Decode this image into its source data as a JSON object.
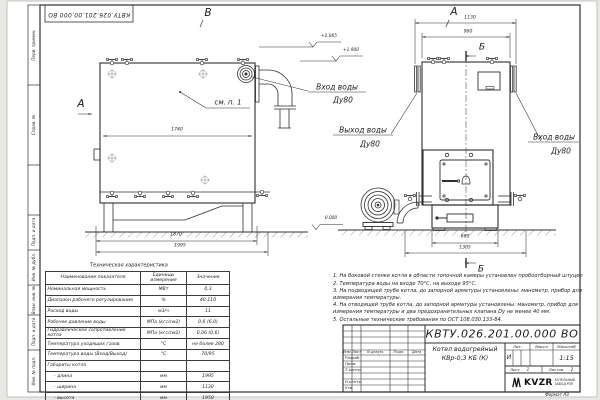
{
  "stamp": "КВТУ.026.201.00.000 ВО",
  "frame_labels": [
    "Перв. примен.",
    "Справ. №",
    "Подп. и дата",
    "Инв. № дубл.",
    "Взам. инв. №",
    "Подп. и дата",
    "Инв. № подл."
  ],
  "views": {
    "b": "В",
    "a_top": "А",
    "a_side": "А",
    "b_section": "Б"
  },
  "elevations": {
    "top": "+2.065",
    "mid": "+1.900",
    "ground": "0.000"
  },
  "callout": "см. п. 1",
  "dims": {
    "side_width": "1740",
    "side_base": "1870",
    "side_total": "1995",
    "front_total": "1130",
    "front_top": "960",
    "front_base": "660",
    "front_span": "1305"
  },
  "pipe_labels": {
    "inlet_side": {
      "l1": "Вход воды",
      "l2": "Ду80"
    },
    "outlet_front": {
      "l1": "Выход воды",
      "l2": "Ду80"
    },
    "inlet_front": {
      "l1": "Вход воды",
      "l2": "Ду80"
    }
  },
  "tech_table": {
    "title": "Техническая характеристика",
    "headers": [
      "Наименование показателя",
      "Единицы измерения",
      "Значение"
    ],
    "rows": [
      [
        "Номинальная мощность",
        "МВт",
        "0,3"
      ],
      [
        "Диапазон рабочего регулирования",
        "%",
        "40-110"
      ],
      [
        "Расход воды",
        "м3/ч",
        "11"
      ],
      [
        "Рабочее давление воды",
        "МПа (кгс/см2)",
        "0,6 (6,0)"
      ],
      [
        "Гидравлическое сопротивление котла",
        "МПа (кгс/см2)",
        "0,06 (0,6)"
      ],
      [
        "Температура уходящих газов",
        "°С",
        "не более 280"
      ],
      [
        "Температура воды (Вход/Выход)",
        "°С",
        "70/95"
      ],
      [
        "Габариты котла",
        "",
        ""
      ],
      [
        "- длина",
        "мм",
        "1995"
      ],
      [
        "- ширина",
        "мм",
        "1130"
      ],
      [
        "- высота",
        "мм",
        "1950"
      ]
    ]
  },
  "notes": [
    "1.  На боковой стенке котла в области топочной камеры установлен пробоотборный штуцер",
    "2.  Температура воды на входе 70°С, на выходе 95°С.",
    "3.  На подводящей трубе котла, до запорной арматуры установлены: манометр, прибор для измерения температуры.",
    "4.  На отводящей трубе котла, до запорной арматуры установлены: манометр, прибор для измерения температуры и два предохранительных клапана Dу не менее 40 мм.",
    "5.  Остальные технические требования по ОСТ 108.030.133-84."
  ],
  "title_block": {
    "doc_number": "КВТУ.026.201.00.000 ВО",
    "product": "Котел водогрейный",
    "product2": "КВр-0,3 КБ (К)",
    "lit_label": "Лит.",
    "mass_label": "Масса",
    "scale_label": "Масштаб",
    "lit": "И",
    "scale": "1:15",
    "sheet_label": "Лист",
    "sheet": "1",
    "sheets_label": "Листов",
    "sheets": "2",
    "cols": {
      "izm": "Изм.",
      "list": "Лист",
      "doc": "N докум.",
      "sign": "Подп.",
      "date": "Дата"
    },
    "rows": [
      "Разраб.",
      "Пров.",
      "Т.контр.",
      "Н.контр.",
      "Утв."
    ],
    "company": "KVZR",
    "company_line1": "КОТЕЛЬНЫЙ",
    "company_line2": "ЗАВОД РЭП",
    "format": "Формат А3"
  },
  "watermark": "KVZR.RU",
  "colors": {
    "line": "#2f2f2f",
    "paper": "#ffffff",
    "bg": "#e8e8e5"
  }
}
